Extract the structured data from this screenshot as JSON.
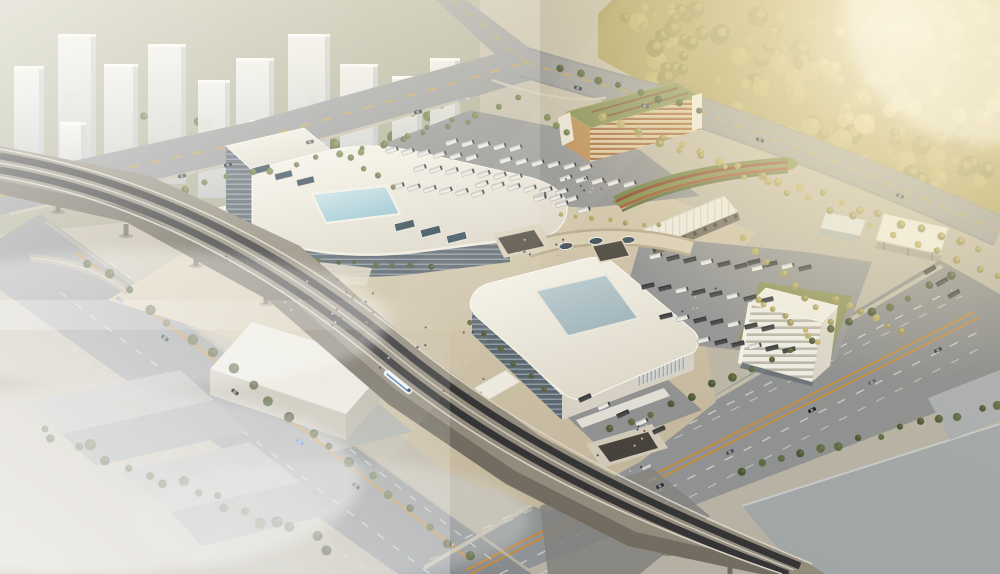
{
  "meta": {
    "title": "Aerial architectural rendering of an intermodal transit hub",
    "canvas_width": 1000,
    "canvas_height": 574,
    "visible_text": "none",
    "viewpoint": "high oblique bird's-eye view, warm sunlight from upper right, haze over city at upper left and fog at lower left"
  },
  "palette": {
    "ground": "#bfb8a7",
    "cityGround": "#9ba287",
    "towerLight": "#f1f3f1",
    "towerDark": "#bcc2c5",
    "forestBase": "#a89c5e",
    "treeOlive": "#67743f",
    "treeDark": "#49552f",
    "treeGold": "#a89a55",
    "road": "#95989b",
    "roadDark": "#868a8d",
    "laneWhite": "#d9dad8",
    "laneYellow": "#d2a43c",
    "laneOrange": "#c9872f",
    "plaza": "#cfc3ab",
    "plazaShade": "#b4a890",
    "asphaltLot": "#8f9194",
    "viaduct": "#8e887b",
    "viaductSide": "#6e695e",
    "track": "#2d2e31",
    "roofWhite": "#f1eee6",
    "roofShade": "#d8d4c9",
    "glassDark": "#55616c",
    "skylightPool": "#a9d2df",
    "skylightGray": "#a9bfc9",
    "garageStripe": "#a4683a",
    "garageRoof": "#7e8a50",
    "canopyWhite": "#eceae2",
    "busWhite": "#e9e9e6",
    "busDark": "#3c4144",
    "warehouseGray": "#a3a8ab",
    "fogWhite": "#ffffff",
    "sunGlow": "#fff4d8",
    "trainBlue": "#2e6fba",
    "moundRed": "#8a3f2a",
    "moundGreen": "#6e7c42"
  },
  "scene": {
    "regions": [
      {
        "name": "city-skyline",
        "desc": "hazy white high-rise towers with trees, upper left"
      },
      {
        "name": "sunlit-forest",
        "desc": "dense golden-green woodland, upper right"
      },
      {
        "name": "road-intersection",
        "desc": "arterial crossroads with large curved corner, top center"
      },
      {
        "name": "elevated-rail-viaduct",
        "desc": "multi-track elevated railway crossing the site diagonally with a train"
      },
      {
        "name": "west-terminal-building",
        "desc": "white curved-roof terminal with corner tower and pale blue skylight"
      },
      {
        "name": "east-terminal-building",
        "desc": "rounded white terminal with large grey-blue roof skylight and bus bays"
      },
      {
        "name": "pedestrian-plaza",
        "desc": "beige plaza with sunken courts and scattered people"
      },
      {
        "name": "bus-parking-lots",
        "desc": "rows of parked coaches north and east of the terminals"
      },
      {
        "name": "parking-garage",
        "desc": "long louvered garage with orange-brown bands and green roof"
      },
      {
        "name": "office-building",
        "desc": "mid-rise building with curved white floor bands near the east road"
      },
      {
        "name": "bus-canopies",
        "desc": "long white platform canopy and flat shade canopy"
      },
      {
        "name": "landscape-mound",
        "desc": "striped red and green planted mound"
      },
      {
        "name": "warehouse-district",
        "desc": "foggy low industrial sheds lower left, flat grey roofs lower right"
      },
      {
        "name": "wide-boulevards",
        "desc": "multi-lane roads with yellow centre lines and sparse cars, lower left and right"
      }
    ]
  }
}
